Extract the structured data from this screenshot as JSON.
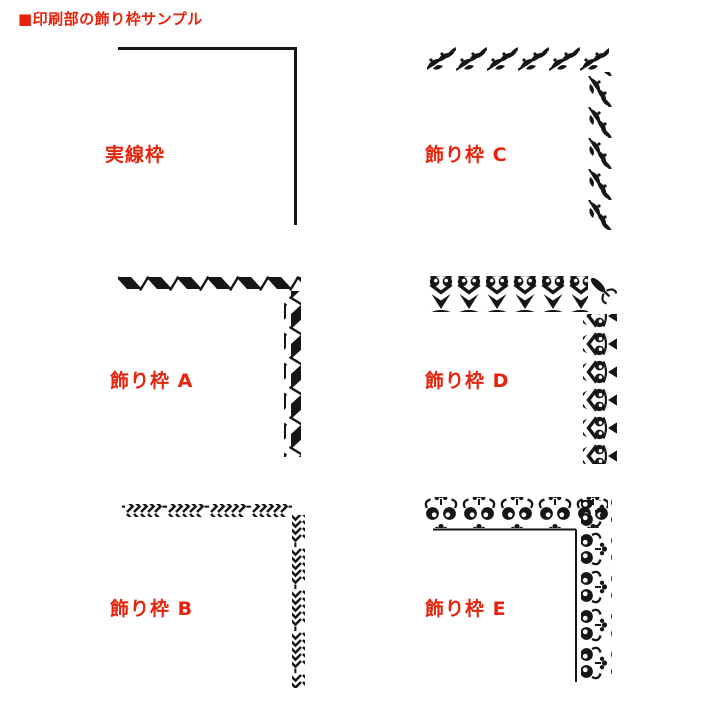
{
  "page": {
    "title": "■印刷部の飾り枠サンプル",
    "description": "Sample sheet of decorative corner borders for the print section"
  },
  "colors": {
    "accent_red": "#e8230b",
    "border_black": "#161616",
    "background": "#ffffff"
  },
  "samples": [
    {
      "id": "solid",
      "label": "実線枠",
      "pattern": "solid-line-corner"
    },
    {
      "id": "C",
      "label": "飾り枠 C",
      "pattern": "leaf-vine-corner"
    },
    {
      "id": "A",
      "label": "飾り枠 A",
      "pattern": "twisted-ribbon-corner"
    },
    {
      "id": "D",
      "label": "飾り枠 D",
      "pattern": "heart-scroll-corner"
    },
    {
      "id": "B",
      "label": "飾り枠 B",
      "pattern": "chevron-arrow-corner"
    },
    {
      "id": "E",
      "label": "飾り枠 E",
      "pattern": "floral-scroll-corner"
    }
  ]
}
